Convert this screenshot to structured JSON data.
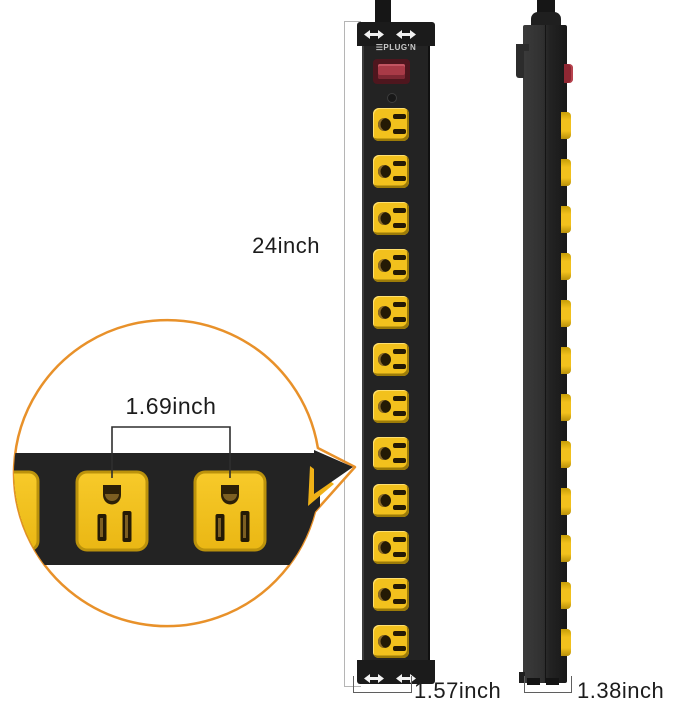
{
  "annotations": {
    "strip_length": "24inch",
    "front_width": "1.57inch",
    "side_depth": "1.38inch",
    "outlet_spacing": "1.69inch"
  },
  "brand": {
    "logo_text": "PLUG'N"
  },
  "product": {
    "front_outlet_count": 12,
    "side_outlet_count": 12
  },
  "colors": {
    "outlet_yellow": "#f2c11d",
    "strip_black": "#232323",
    "callout_orange": "#e8912a",
    "switch_red": "#a83a47",
    "label_text": "#1c1c1c"
  }
}
